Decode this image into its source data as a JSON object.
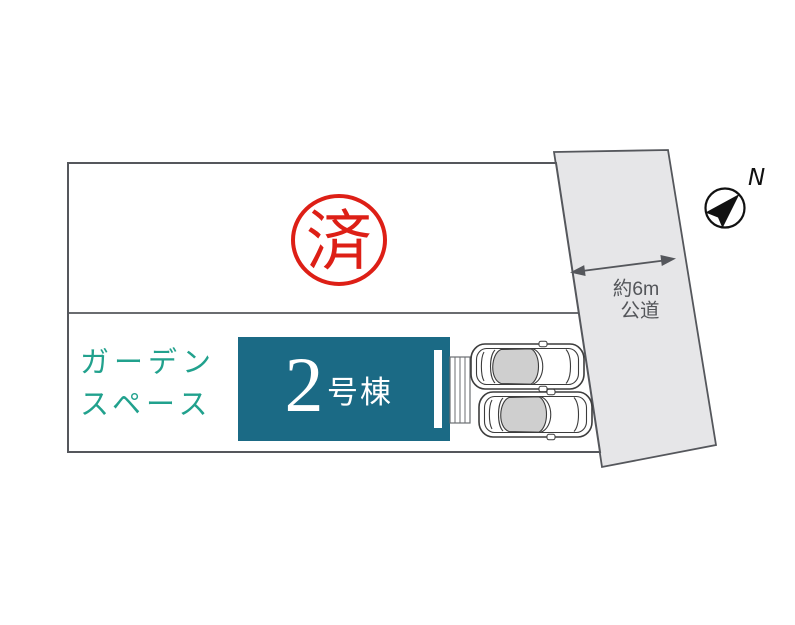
{
  "site_plan": {
    "sold_stamp": "済",
    "garden_space": {
      "line1": "ガーデン",
      "line2": "スペース"
    },
    "building": {
      "number": "2",
      "suffix": "号棟"
    },
    "road": {
      "width_label": "約6m",
      "type_label": "公道"
    },
    "compass": {
      "north_label": "N"
    }
  },
  "colors": {
    "building_fill": "#1b6a85",
    "garden_text": "#21a18d",
    "stamp_red": "#dd1f16",
    "road_fill": "#e6e6e8",
    "outline_gray": "#55575c"
  }
}
